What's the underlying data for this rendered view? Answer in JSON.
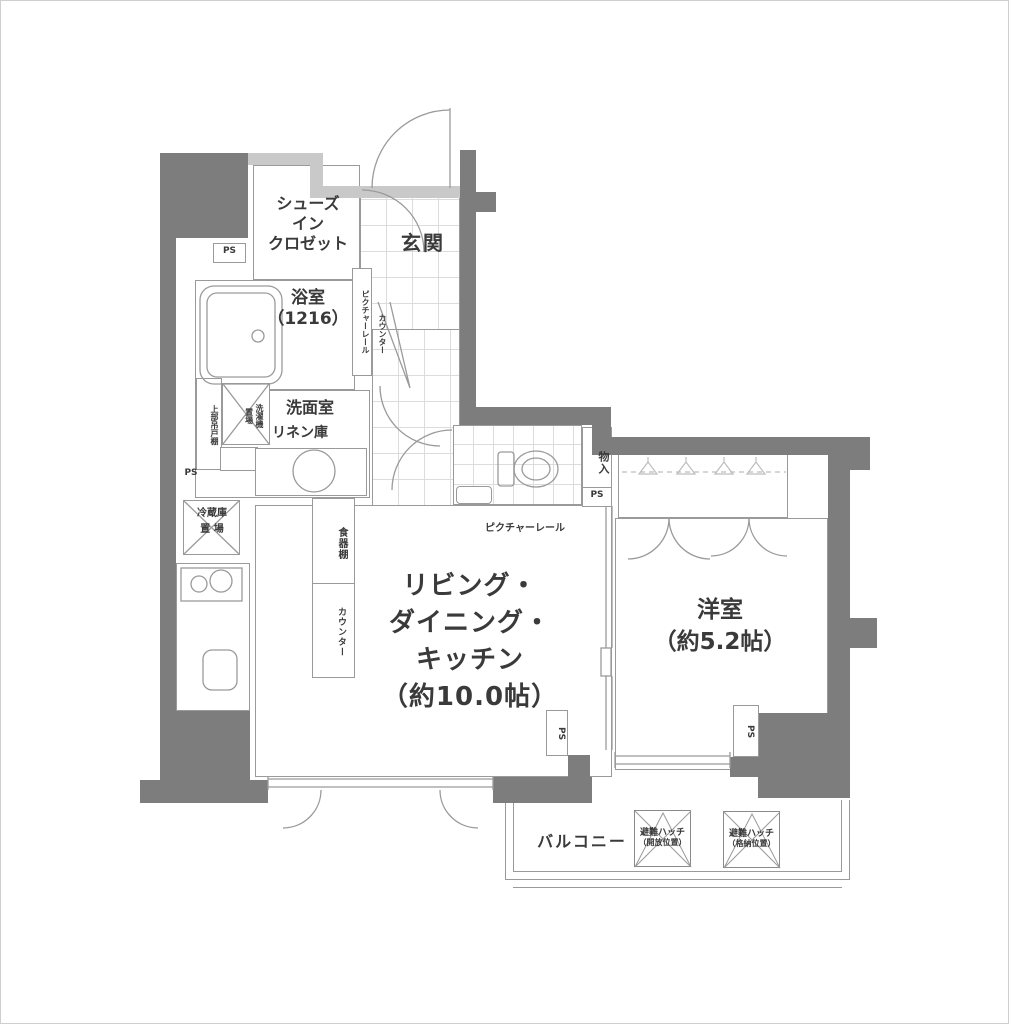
{
  "colors": {
    "wall_dark": "#7d7d7d",
    "wall_light": "#c9c9c9",
    "line": "#9a9a9a",
    "text": "#3a3a3a",
    "background": "#ffffff"
  },
  "rooms": {
    "entrance": {
      "label": "玄関"
    },
    "shoes_in_closet": {
      "label": "シューズ\nイン\nクロゼット"
    },
    "bathroom": {
      "label": "浴室\n（1216）"
    },
    "washroom": {
      "label": "洗面室",
      "linen_label": "リネン庫"
    },
    "storage": {
      "label": "物入"
    },
    "ldk": {
      "label": "リビング・\nダイニング・\nキッチン\n（約10.0帖）"
    },
    "western_room": {
      "label": "洋室\n（約5.2帖）"
    },
    "balcony": {
      "label": "バルコニー"
    }
  },
  "fixtures": {
    "upper_cabinet": "上部吊戸棚",
    "washer_space": "洗濯機\n置場",
    "fridge_space": "冷蔵庫\n置 場",
    "cupboard": "食器棚",
    "kitchen_counter": "カウンター",
    "entrance_counter": "カウンター",
    "picture_rail_entrance": "ピクチャーレール",
    "picture_rail_ldk": "ピクチャーレール",
    "pipe_shaft": "PS",
    "hatch_open": {
      "title": "避難ハッチ",
      "sub": "（開放位置）"
    },
    "hatch_stored": {
      "title": "避難ハッチ",
      "sub": "（格納位置）"
    }
  }
}
